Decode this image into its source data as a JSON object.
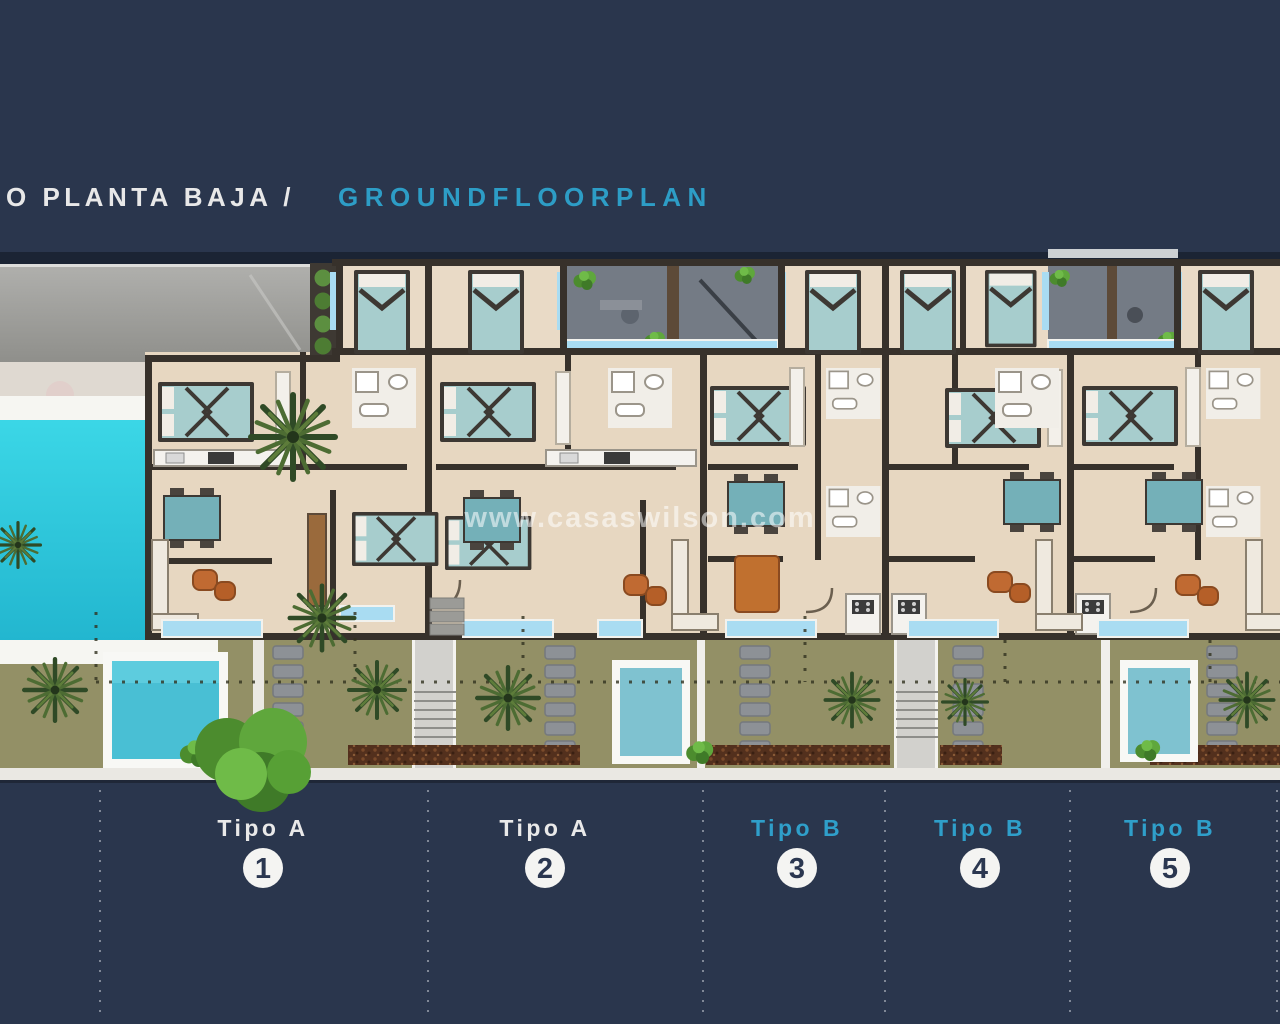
{
  "title": {
    "main": "O PLANTA BAJA /",
    "main_color": "#e8e8e8",
    "english": "GROUNDFLOORPLAN",
    "english_color": "#2d9dc6"
  },
  "watermark": {
    "text": "www.casaswilson.com"
  },
  "plan": {
    "colors": {
      "background": "#2a364d",
      "roof_band": "#1b2434",
      "lawn": "#97946a",
      "road": "#a3a3a0",
      "pool_water": "#25c9dc",
      "plunge_pool_water": "#7fc2d0",
      "floor": "#e7d7c1",
      "wall": "#37312b",
      "patio": "#747b85",
      "terrace_glass": "#a9dcf2",
      "mulch": "#53301d",
      "sidewalk": "#eae8e3",
      "bed": "#a7cdcd",
      "sofa_orange": "#c06a32"
    }
  },
  "units": [
    {
      "type_label": "Tipo A",
      "number": "1",
      "label_color": "#e9e9e9"
    },
    {
      "type_label": "Tipo A",
      "number": "2",
      "label_color": "#e9e9e9"
    },
    {
      "type_label": "Tipo B",
      "number": "3",
      "label_color": "#2f9fca"
    },
    {
      "type_label": "Tipo B",
      "number": "4",
      "label_color": "#2f9fca"
    },
    {
      "type_label": "Tipo B",
      "number": "5",
      "label_color": "#2f9fca"
    }
  ]
}
